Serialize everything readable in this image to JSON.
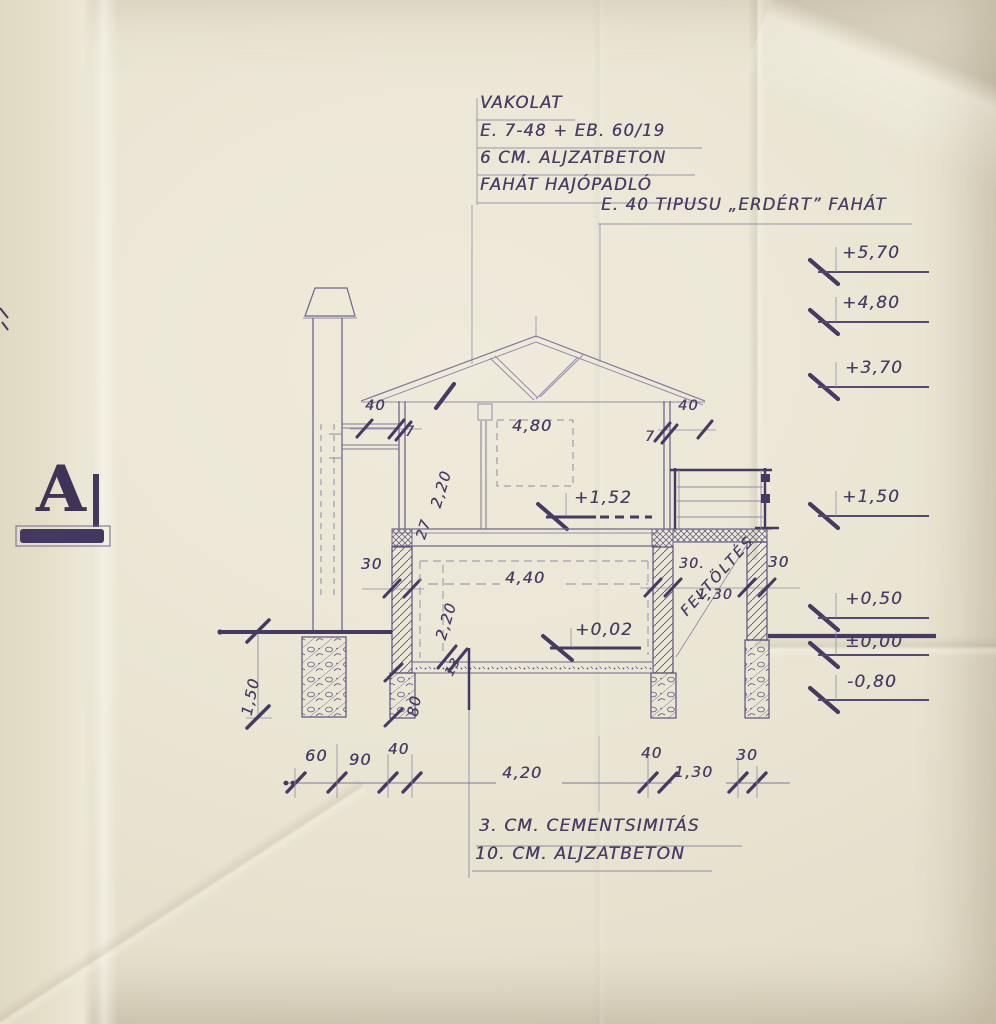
{
  "drawing": {
    "section_label": "A",
    "edge_fragment": "0,20",
    "top_notes": [
      "VAKOLAT",
      "E. 7-48 + EB. 60/19",
      "6 CM. ALJZATBETON",
      "FAHÁT HAJÓPADLÓ"
    ],
    "roof_note": "E. 40 TIPUSU „ERDÉRT” FAHÁT",
    "bottom_notes": [
      "3. CM. CEMENTSIMITÁS",
      "10. CM. ALJZATBETON"
    ],
    "fill_label": "FELTÖLTÉS",
    "levels_right": [
      "+5,70",
      "+4,80",
      "+3,70",
      "+1,50",
      "+0,50",
      "±0,00",
      "-0,80"
    ],
    "levels_inner": [
      "+1,52",
      "+0,02"
    ],
    "dims": {
      "upper_room_width": "4,80",
      "lower_room_width": "4,40",
      "upper_room_height": "2,20",
      "slab_thickness": "27",
      "lower_room_height": "2,20",
      "floor_slab": "13",
      "foundation_height": "80",
      "left_wall": "30",
      "eave_left": "40",
      "eave_left_offset": "7",
      "eave_right": "40",
      "eave_right_offset": "7",
      "terrace_wall": "30.",
      "terrace_width": "1,30",
      "terrace_outer_wall": "30",
      "foundation_depth": "1,50",
      "bottom_chain": [
        "60",
        "90",
        "40",
        "4,20",
        "40",
        "1,30",
        "30"
      ]
    }
  },
  "colors": {
    "paper": "#e9e4d2",
    "ink_dark": "#43385f",
    "ink_mid": "#6a6188",
    "ink_light": "#8f89a6"
  }
}
